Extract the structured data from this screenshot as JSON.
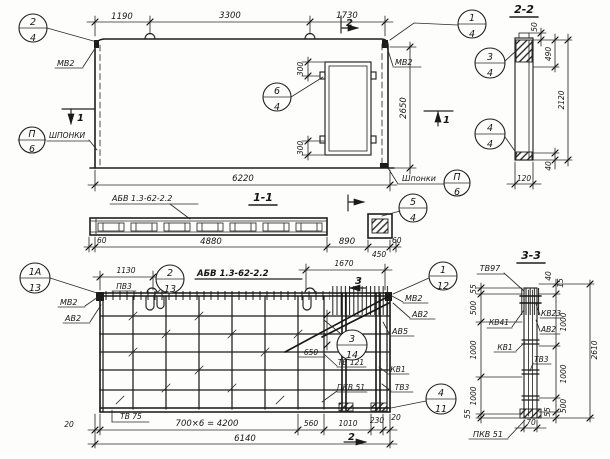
{
  "elevation": {
    "dims": {
      "span1": "1190",
      "span2": "3300",
      "span3": "1730",
      "total": "6220",
      "height": "2650",
      "door_top": "300",
      "door_bottom": "300"
    },
    "labels": {
      "mv2_left": "МВ2",
      "mv2_right": "МВ2",
      "shponki_left": "ШПОНКИ",
      "shponki_right": "Шпонки"
    },
    "markers": {
      "sec2": "2",
      "sec1_left": "1",
      "sec1_right": "1"
    },
    "callouts": {
      "c24": {
        "num": "2",
        "den": "4"
      },
      "c14": {
        "num": "1",
        "den": "4"
      },
      "c64": {
        "num": "6",
        "den": "4"
      },
      "p6_left": {
        "num": "П",
        "den": "6"
      },
      "p6_right": {
        "num": "П",
        "den": "6"
      }
    }
  },
  "section22": {
    "title": "2-2",
    "dims": {
      "d50": "50",
      "d490": "490",
      "d2120": "2120",
      "d40": "40",
      "d120": "120"
    },
    "callouts": {
      "c34": {
        "num": "3",
        "den": "4"
      },
      "c44": {
        "num": "4",
        "den": "4"
      }
    }
  },
  "section11": {
    "title": "1-1",
    "label": "АБВ 1.3-62-2.2",
    "dims": {
      "d60_left": "60",
      "d4880": "4880",
      "d890": "890",
      "d450": "450",
      "d60_right": "60"
    },
    "callouts": {
      "c54": {
        "num": "5",
        "den": "4"
      }
    }
  },
  "plan": {
    "title": "АБВ 1.3-62-2.2",
    "dims": {
      "d1130": "1130",
      "d1670": "1670",
      "d650": "650",
      "d20_left": "20",
      "spacing": "700×6 = 4200",
      "d560": "560",
      "d1010": "1010",
      "d230": "230",
      "d20_right": "20",
      "total": "6140"
    },
    "labels": {
      "pv3": "ПВ3",
      "mv2_left": "МВ2",
      "av2_left": "АВ2",
      "mv2_right": "МВ2",
      "av2_right": "АВ2",
      "av5": "АВ5",
      "kv1": "КВ1",
      "tv3": "ТВ3",
      "pkv51": "ПКВ 51",
      "tv121": "ТВ 121",
      "tv75": "ТВ 75"
    },
    "markers": {
      "sec3": "3",
      "sec2": "2"
    },
    "callouts": {
      "c1a13": {
        "num": "1А",
        "den": "13"
      },
      "c213": {
        "num": "2",
        "den": "13"
      },
      "c112": {
        "num": "1",
        "den": "12"
      },
      "c314": {
        "num": "3",
        "den": "14"
      },
      "c411": {
        "num": "4",
        "den": "11"
      }
    }
  },
  "section33": {
    "title": "3-3",
    "labels": {
      "tv97": "ТВ97",
      "kv41": "КВ41",
      "kv23": "КВ23",
      "av2": "АВ2",
      "kv1": "КВ1",
      "tv3": "ТВ3",
      "pkv51": "ПКВ 51"
    },
    "dims": {
      "left": [
        "55",
        "500",
        "1000",
        "1000",
        "55"
      ],
      "right": [
        "15",
        "40",
        "1000",
        "1000",
        "500",
        "55"
      ],
      "total": "2610",
      "width": "70"
    }
  }
}
